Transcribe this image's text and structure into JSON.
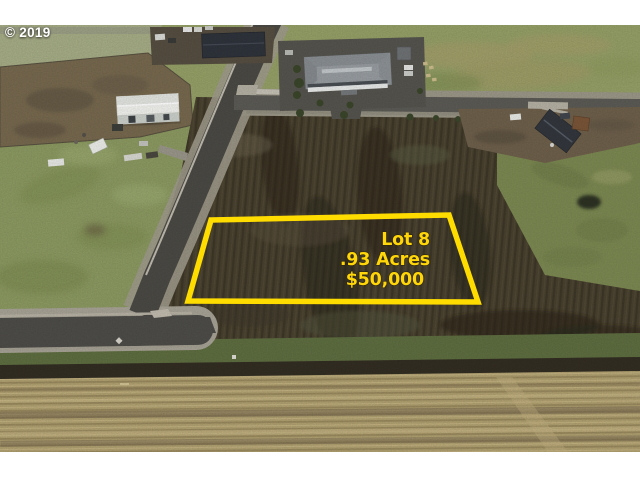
{
  "watermark": {
    "text": "© 2019",
    "color": "#ffffff"
  },
  "lot_overlay": {
    "line1": "Lot 8",
    "line2": ".93 Acres",
    "line3": "$50,000",
    "outline_color": "#ffdc00",
    "text_color": "#ffd60a"
  }
}
